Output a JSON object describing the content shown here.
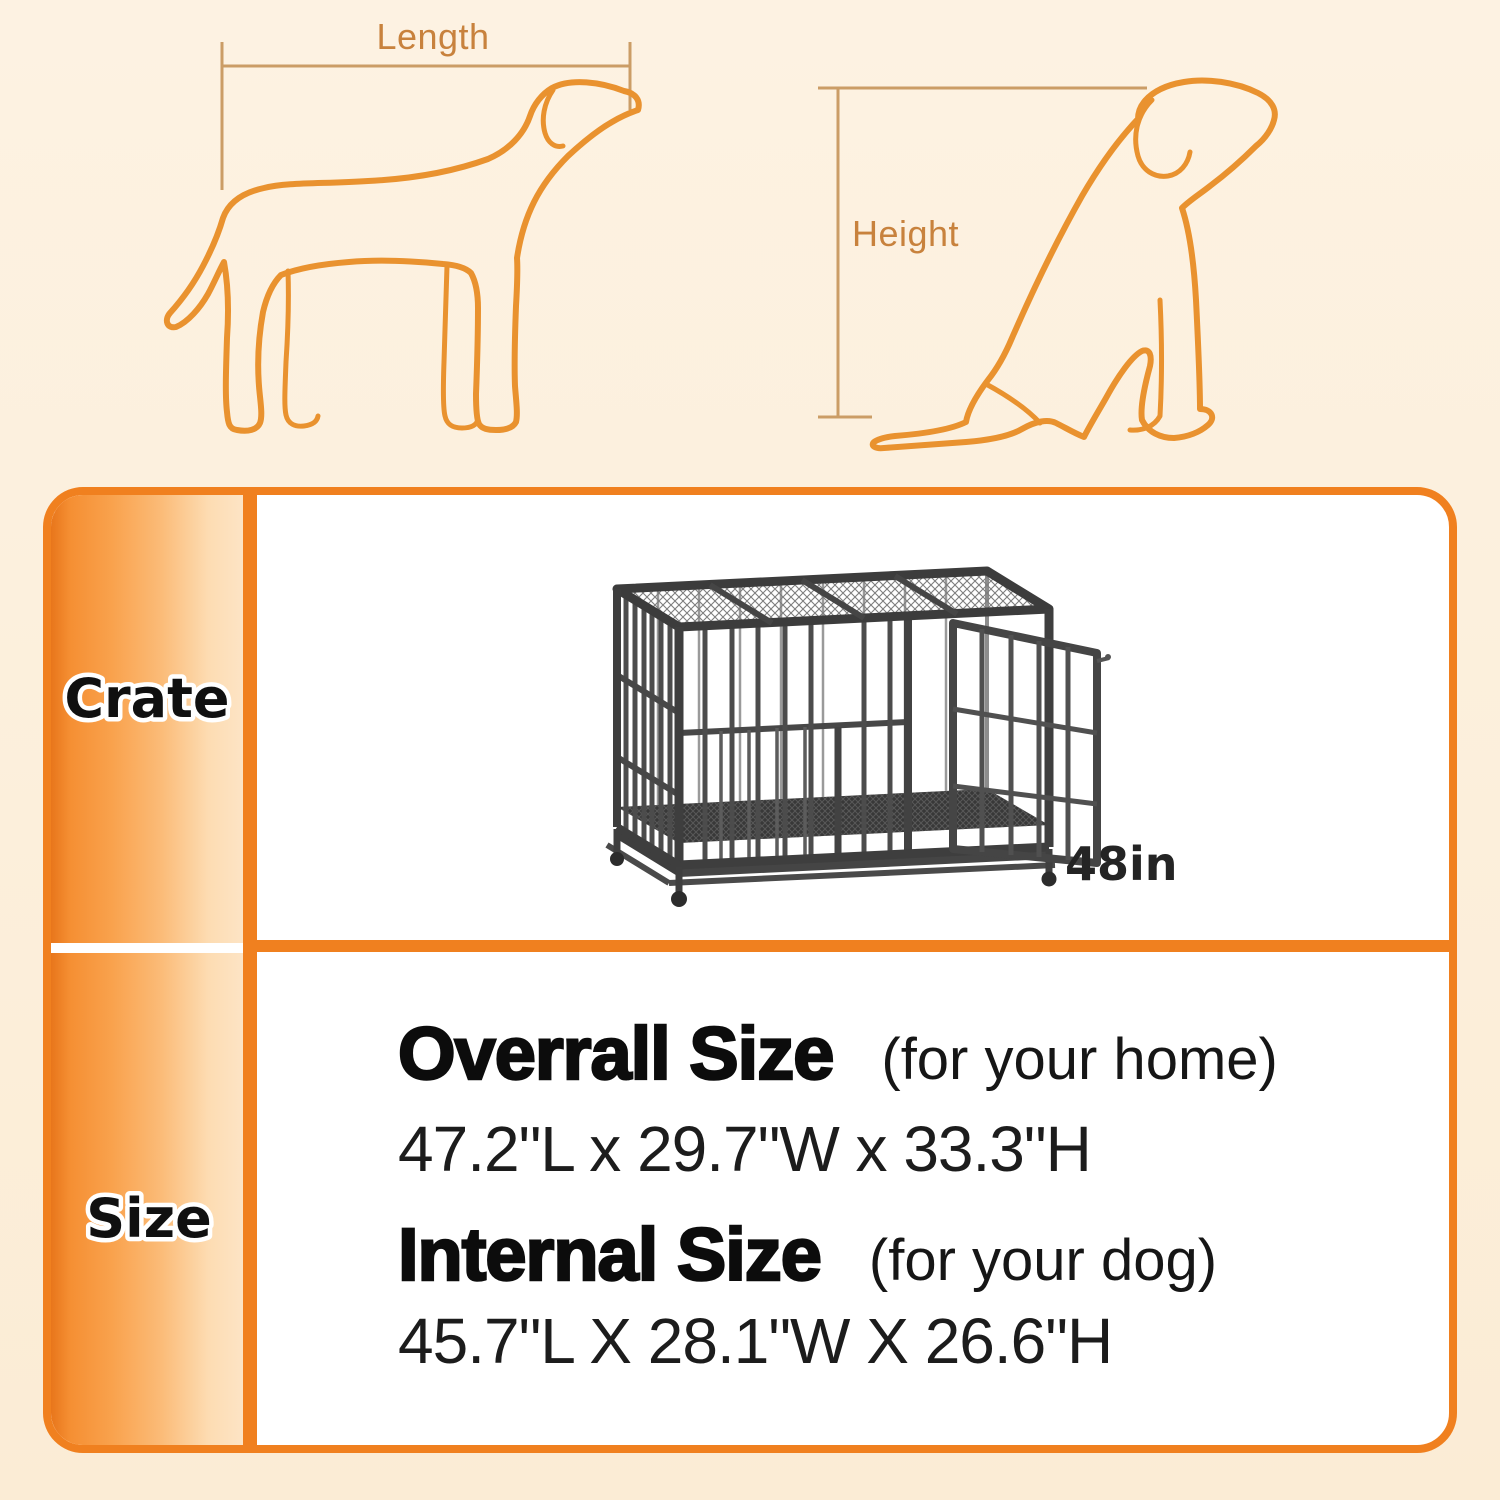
{
  "canvas": {
    "width": 1500,
    "height": 1500,
    "background": "#fcefdc"
  },
  "measure_guide": {
    "length_label": "Length",
    "height_label": "Height",
    "outline_color": "#e9922f",
    "guide_line_color": "#cb9d66",
    "label_color": "#c8823d"
  },
  "size_table": {
    "border_color": "#f0801f",
    "header_gradient_start": "#ee7d1e",
    "header_gradient_end": "#fde4c5",
    "crate_row": {
      "header": "Crate",
      "crate_image": "metal-dog-crate-48-inch",
      "size_label": "48in"
    },
    "size_row": {
      "header": "Size",
      "overall": {
        "title": "Overrall Size",
        "note": "(for your home)",
        "dimensions": "47.2\"L x 29.7\"W x 33.3\"H"
      },
      "internal": {
        "title": "Internal Size",
        "note": "(for your dog)",
        "dimensions": "45.7\"L X 28.1\"W X 26.6\"H"
      }
    }
  }
}
